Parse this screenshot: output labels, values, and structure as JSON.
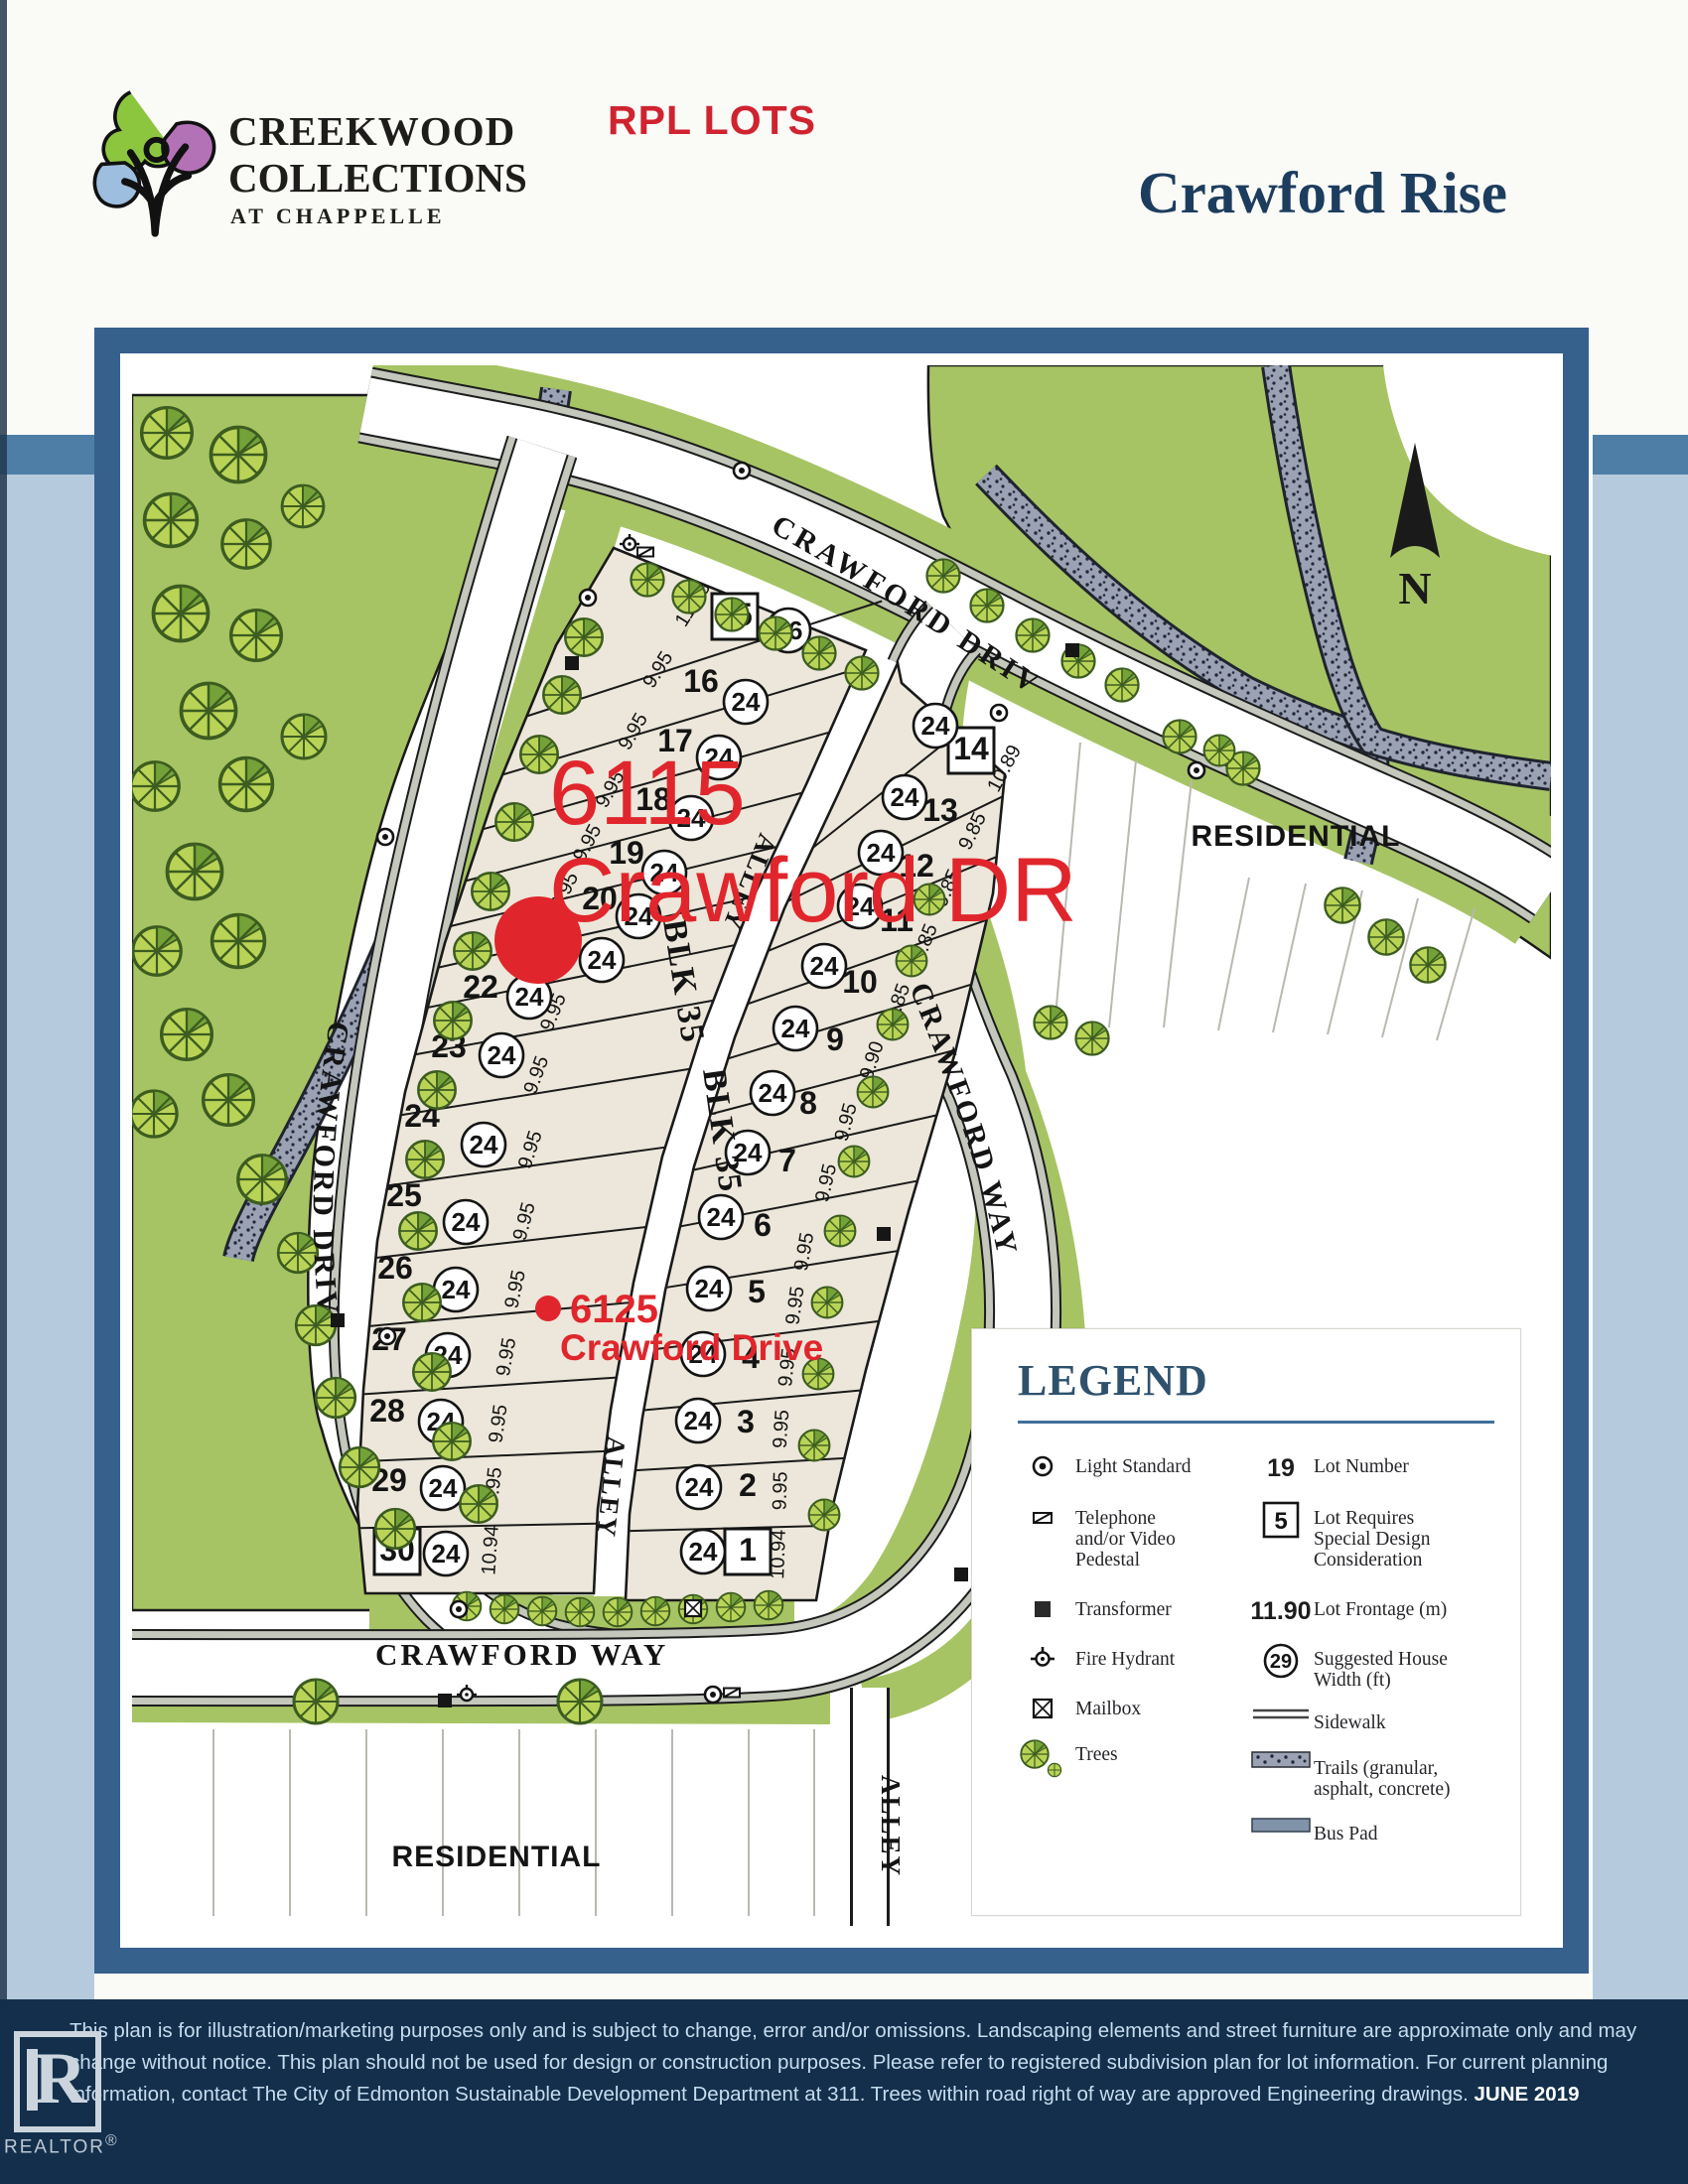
{
  "header": {
    "brand_top": "CREEKWOOD",
    "brand_mid": "COLLECTIONS",
    "brand_bottom": "AT CHAPPELLE",
    "annotation": "RPL LOTS",
    "title": "Crawford Rise"
  },
  "map": {
    "north": "N",
    "streets": {
      "crawford_drive_top": "CRAWFORD DRIVE",
      "crawford_drive_left": "CRAWFORD DRIVE",
      "crawford_way_right": "CRAWFORD WAY",
      "crawford_way_bottom": "CRAWFORD WAY"
    },
    "areas": {
      "residential_right": "RESIDENTIAL",
      "residential_bottom": "RESIDENTIAL"
    },
    "blocks": {
      "blk_left": "BLK 35",
      "blk_right": "BLK 35",
      "alley_upper": "ALLEY",
      "alley_lower": "ALLEY",
      "alley_south": "ALLEY"
    },
    "red_annotations": {
      "primary_number": "6115",
      "primary_street": "Crawford DR",
      "secondary_number": "6125",
      "secondary_street": "Crawford Drive",
      "color": "#e0262c"
    },
    "left_lots": [
      {
        "num": "15",
        "house_width": "26",
        "frontage": "11.53",
        "boxed": true
      },
      {
        "num": "16",
        "house_width": "24",
        "frontage": "9.95",
        "boxed": false
      },
      {
        "num": "17",
        "house_width": "24",
        "frontage": "9.95",
        "boxed": false
      },
      {
        "num": "18",
        "house_width": "24",
        "frontage": "9.95",
        "boxed": false
      },
      {
        "num": "19",
        "house_width": "24",
        "frontage": "9.95",
        "boxed": false
      },
      {
        "num": "20",
        "house_width": "24",
        "frontage": "9.95",
        "boxed": false
      },
      {
        "num": "21",
        "house_width": "24",
        "frontage": "9.95",
        "boxed": false
      },
      {
        "num": "22",
        "house_width": "24",
        "frontage": "9.95",
        "boxed": false
      },
      {
        "num": "23",
        "house_width": "24",
        "frontage": "9.95",
        "boxed": false
      },
      {
        "num": "24",
        "house_width": "24",
        "frontage": "9.95",
        "boxed": false
      },
      {
        "num": "25",
        "house_width": "24",
        "frontage": "9.95",
        "boxed": false
      },
      {
        "num": "26",
        "house_width": "24",
        "frontage": "9.95",
        "boxed": false
      },
      {
        "num": "27",
        "house_width": "24",
        "frontage": "9.95",
        "boxed": false
      },
      {
        "num": "28",
        "house_width": "24",
        "frontage": "9.95",
        "boxed": false
      },
      {
        "num": "29",
        "house_width": "24",
        "frontage": "9.95",
        "boxed": false
      },
      {
        "num": "30",
        "house_width": "24",
        "frontage": "10.94",
        "boxed": true
      }
    ],
    "right_lots": [
      {
        "num": "14",
        "house_width": "24",
        "frontage": "10.89",
        "boxed": true
      },
      {
        "num": "13",
        "house_width": "24",
        "frontage": "9.85",
        "boxed": false
      },
      {
        "num": "12",
        "house_width": "24",
        "frontage": "9.85",
        "boxed": false
      },
      {
        "num": "11",
        "house_width": "24",
        "frontage": "9.85",
        "boxed": false
      },
      {
        "num": "10",
        "house_width": "24",
        "frontage": "9.85",
        "boxed": false
      },
      {
        "num": "9",
        "house_width": "24",
        "frontage": "9.90",
        "boxed": false
      },
      {
        "num": "8",
        "house_width": "24",
        "frontage": "9.95",
        "boxed": false
      },
      {
        "num": "7",
        "house_width": "24",
        "frontage": "9.95",
        "boxed": false
      },
      {
        "num": "6",
        "house_width": "24",
        "frontage": "9.95",
        "boxed": false
      },
      {
        "num": "5",
        "house_width": "24",
        "frontage": "9.95",
        "boxed": false
      },
      {
        "num": "4",
        "house_width": "24",
        "frontage": "9.95",
        "boxed": false
      },
      {
        "num": "3",
        "house_width": "24",
        "frontage": "9.95",
        "boxed": false
      },
      {
        "num": "2",
        "house_width": "24",
        "frontage": "9.95",
        "boxed": false
      },
      {
        "num": "1",
        "house_width": "24",
        "frontage": "10.94",
        "boxed": true
      }
    ]
  },
  "legend": {
    "title": "LEGEND",
    "left_items": [
      {
        "icon": "light-standard",
        "label": "Light Standard"
      },
      {
        "icon": "telephone-pedestal",
        "label": "Telephone\nand/or Video\nPedestal"
      },
      {
        "icon": "transformer",
        "label": "Transformer"
      },
      {
        "icon": "fire-hydrant",
        "label": "Fire Hydrant"
      },
      {
        "icon": "mailbox",
        "label": "Mailbox"
      },
      {
        "icon": "trees",
        "label": "Trees"
      }
    ],
    "right_items": [
      {
        "symbol": "19",
        "style": "plain",
        "label": "Lot Number"
      },
      {
        "symbol": "5",
        "style": "boxed",
        "label": "Lot Requires\nSpecial Design\nConsideration"
      },
      {
        "symbol": "11.90",
        "style": "plain",
        "label": "Lot Frontage (m)"
      },
      {
        "symbol": "29",
        "style": "circled",
        "label": "Suggested House\nWidth (ft)"
      },
      {
        "icon": "sidewalk",
        "label": "Sidewalk"
      },
      {
        "icon": "trails",
        "label": "Trails (granular,\nasphalt, concrete)"
      },
      {
        "icon": "bus-pad",
        "label": "Bus Pad"
      }
    ]
  },
  "footer": {
    "disclaimer": "This plan is for illustration/marketing purposes only and is subject to change, error and/or omissions. Landscaping elements and street furniture are approximate only and may change without notice. This plan should not be used for design or construction purposes. Please refer to registered subdivision plan for lot information. For current planning information, contact The City of Edmonton Sustainable Development Department at 311. Trees within road right of way are approved Engineering drawings.",
    "date": "JUNE 2019",
    "realtor_symbol": "R",
    "realtor_label": "REALTOR",
    "reg_mark": "®"
  }
}
